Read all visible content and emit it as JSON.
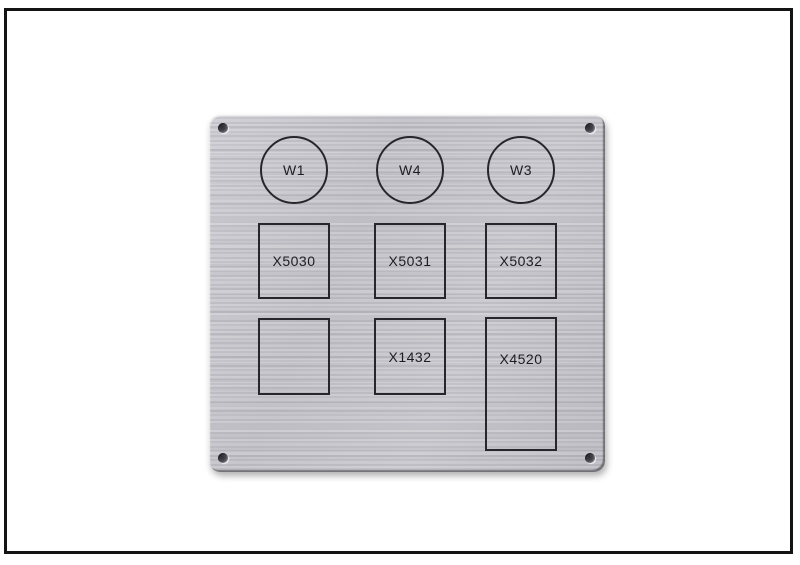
{
  "image": {
    "description": "Photo of a brushed aluminium engraved panel label with drilled corner holes, framed by a black border on white",
    "background_color": "#ffffff",
    "frame_color": "#141414"
  },
  "panel": {
    "material": "brushed-aluminium",
    "base_color": "#c6c5cb",
    "engraving_color": "#26262b",
    "circles": [
      {
        "label": "W1"
      },
      {
        "label": "W4"
      },
      {
        "label": "W3"
      }
    ],
    "boxes_row1": [
      {
        "label": "X5030"
      },
      {
        "label": "X5031"
      },
      {
        "label": "X5032"
      }
    ],
    "boxes_row2": [
      {
        "label": ""
      },
      {
        "label": "X1432"
      },
      {
        "label": "X4520"
      }
    ]
  }
}
